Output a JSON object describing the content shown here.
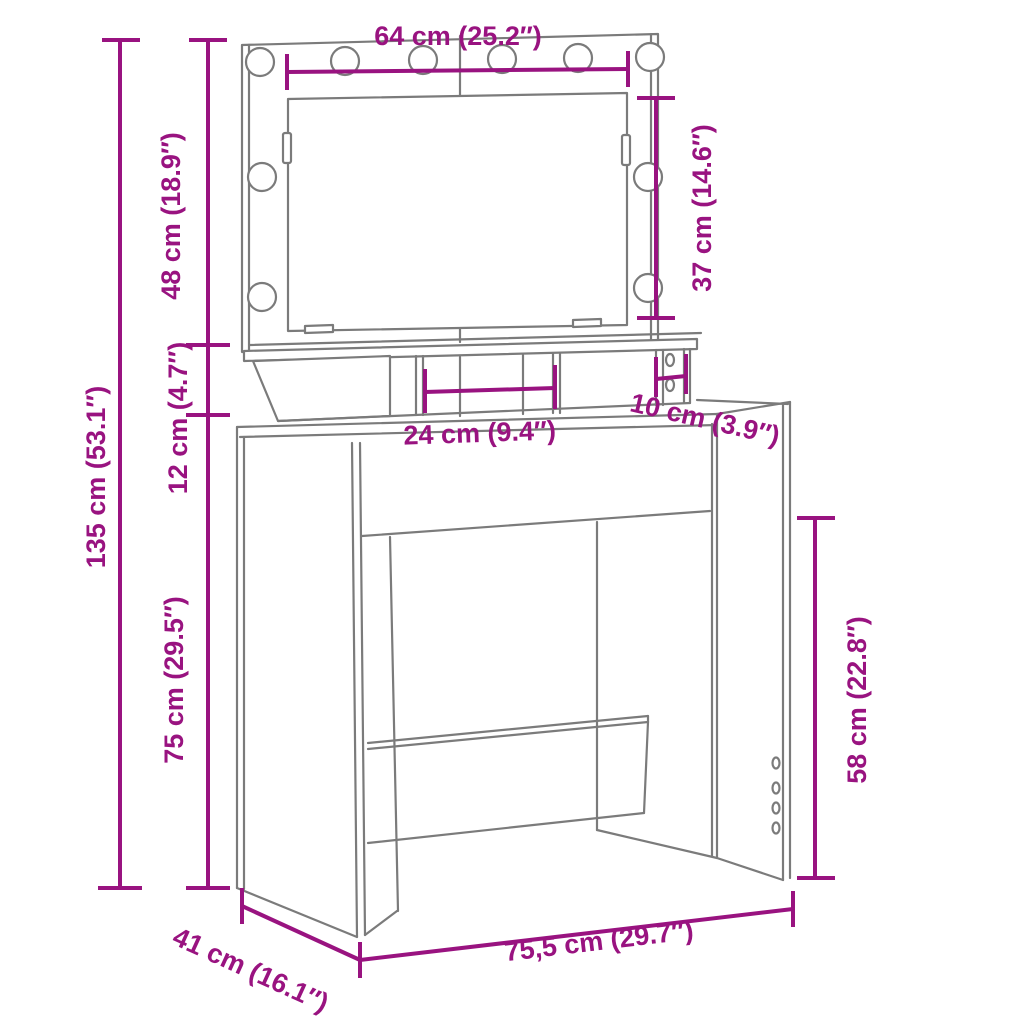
{
  "diagram": {
    "type": "furniture-dimension-drawing",
    "product": "dressing table with LED mirror",
    "background": "#ffffff"
  },
  "colors": {
    "dimension_accent": "#991380",
    "drawing_line": "#7b7b7b"
  },
  "dimensions": {
    "mirror_width": "64 cm (25.2″)",
    "mirror_height": "37 cm (14.6″)",
    "upper_section_height": "48 cm (18.9″)",
    "shelf_section_height": "12 cm (4.7″)",
    "total_height": "135 cm (53.1″)",
    "table_height": "75 cm (29.5″)",
    "middle_compartment_width": "24 cm (9.4″)",
    "side_compartment_width": "10 cm (3.9″)",
    "leg_clearance_height": "58 cm (22.8″)",
    "depth": "41 cm (16.1″)",
    "total_width": "75,5 cm (29.7″)"
  },
  "counts": {
    "led_bulbs": 10
  }
}
